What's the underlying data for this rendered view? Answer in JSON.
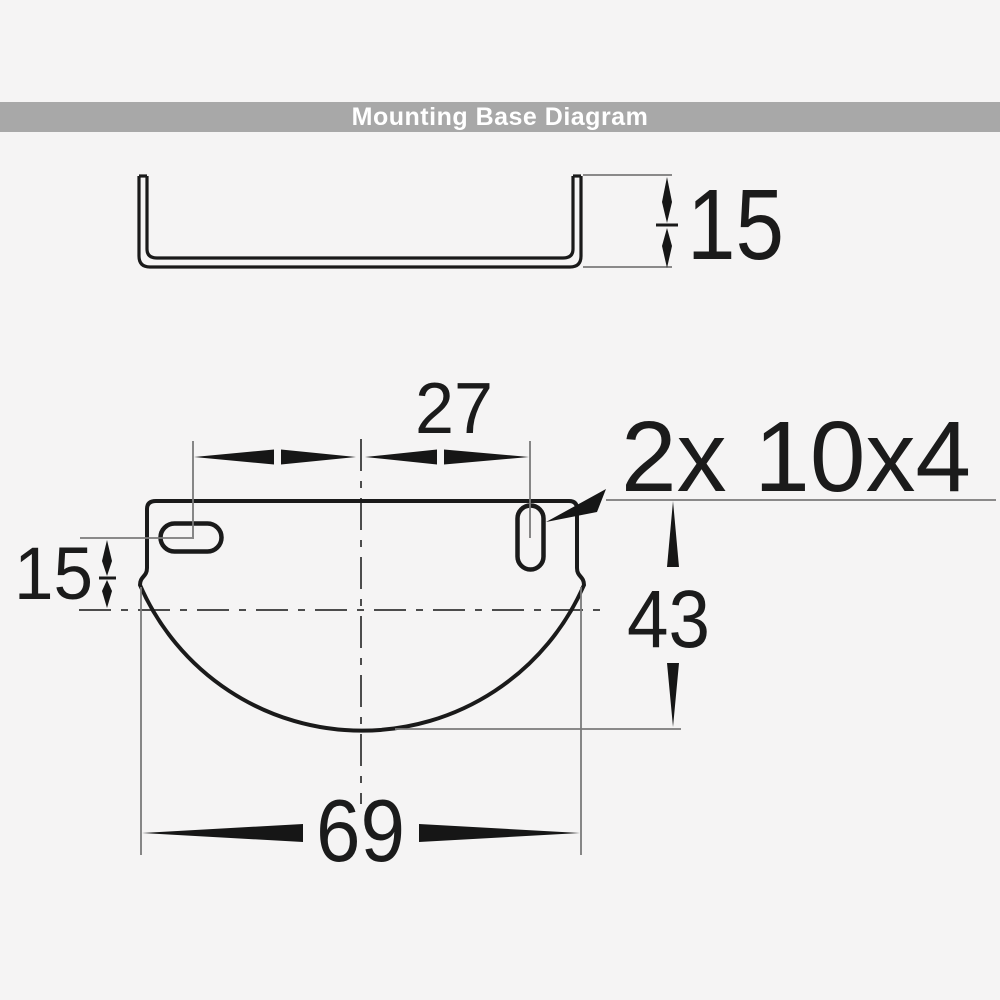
{
  "header": {
    "title": "Mounting Base Diagram",
    "bar_color": "#a8a8a8",
    "text_color": "#ffffff"
  },
  "colors": {
    "background": "#f5f4f4",
    "outline": "#1a1a1a",
    "extension_lines": "#7a7a7a",
    "centerlines": "#4c4c4c"
  },
  "side_view": {
    "dimensions": {
      "height": "15"
    }
  },
  "front_view": {
    "dimensions": {
      "slot_spacing": "27",
      "slot_size": "2x 10x4",
      "slot_offset_from_center": "15",
      "center_to_bottom": "43",
      "overall_width": "69"
    }
  }
}
